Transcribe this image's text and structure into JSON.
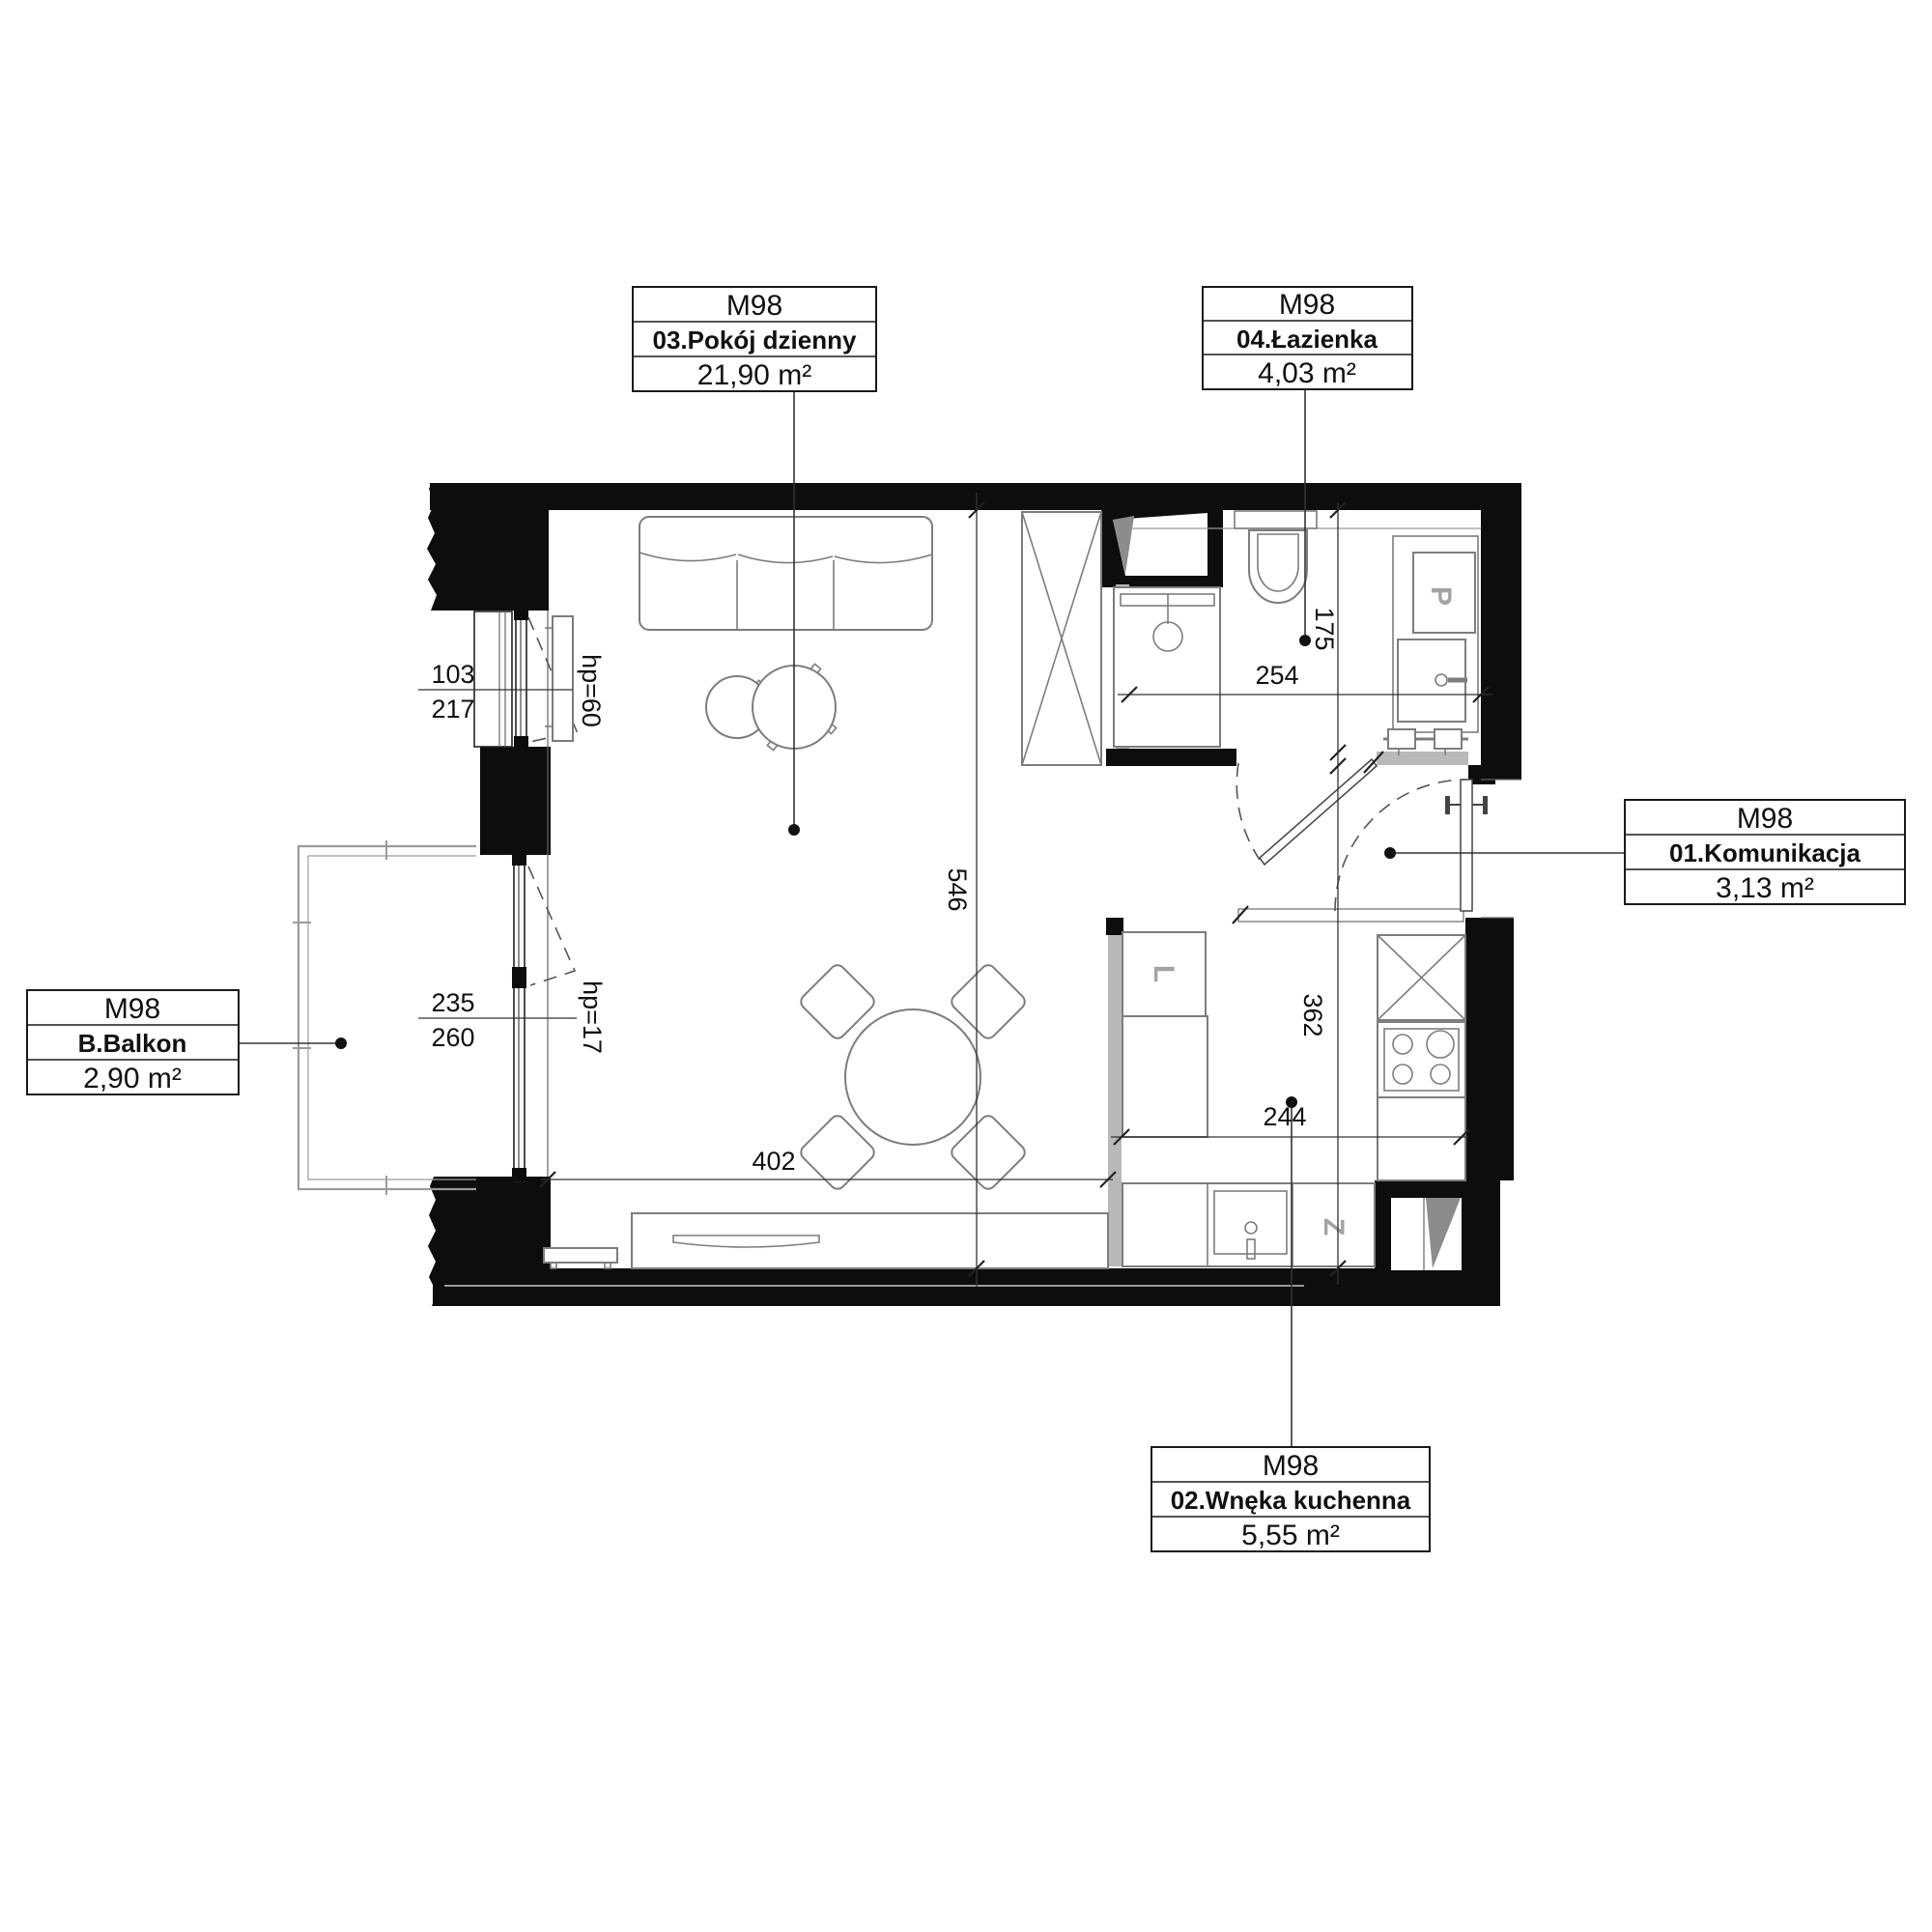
{
  "unit": "M98",
  "labels": {
    "living": {
      "unit": "M98",
      "name": "03.Pokój dzienny",
      "area": "21,90 m²"
    },
    "bathroom": {
      "unit": "M98",
      "name": "04.Łazienka",
      "area": "4,03 m²"
    },
    "hall": {
      "unit": "M98",
      "name": "01.Komunikacja",
      "area": "3,13 m²"
    },
    "balcony": {
      "unit": "M98",
      "name": "B.Balkon",
      "area": "2,90 m²"
    },
    "kitchen": {
      "unit": "M98",
      "name": "02.Wnęka kuchenna",
      "area": "5,55 m²"
    }
  },
  "dimensions": {
    "living_width": "402",
    "living_depth": "546",
    "bathroom_width": "254",
    "bathroom_depth": "175",
    "kitchen_width": "244",
    "kitchen_depth": "362",
    "window_upper": {
      "upper": "103",
      "lower": "217",
      "hp": "hp=60"
    },
    "balcony_door": {
      "upper": "235",
      "lower": "260",
      "hp": "hp=17"
    }
  },
  "appliances": {
    "fridge": "L",
    "dishwasher": "Z",
    "washer": "P"
  }
}
